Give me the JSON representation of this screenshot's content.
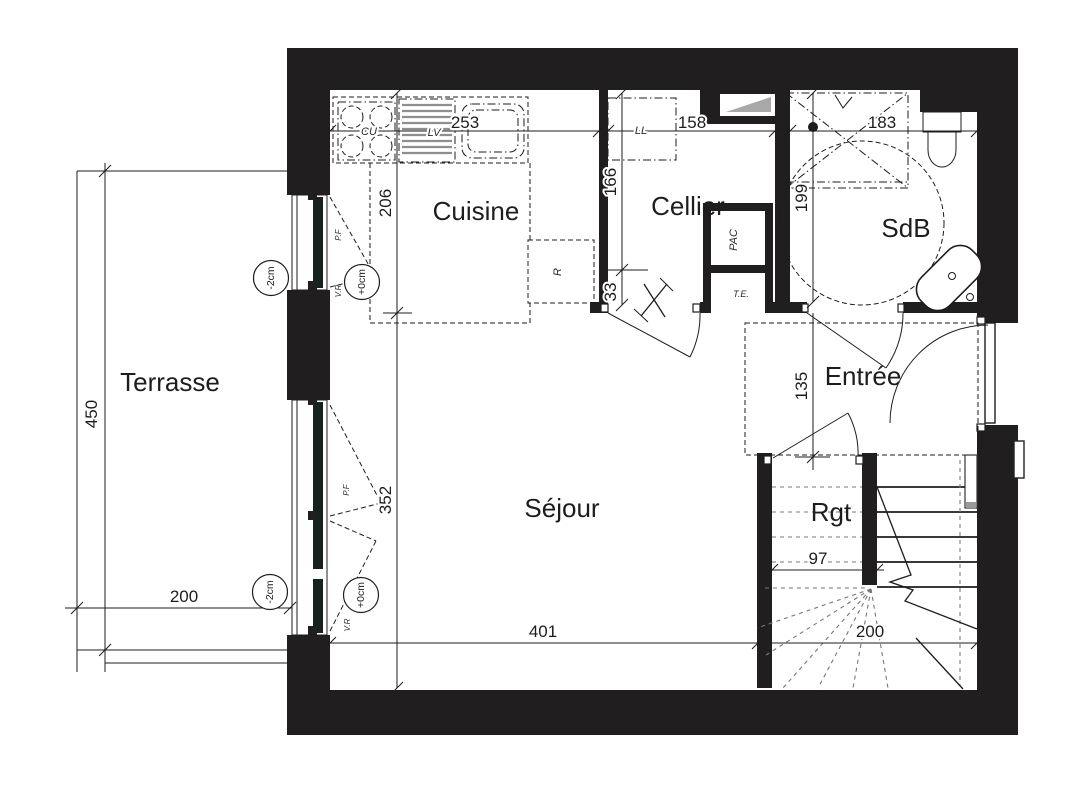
{
  "rooms": {
    "terrace": "Terrasse",
    "kitchen": "Cuisine",
    "cellar": "Cellier",
    "bath": "SdB",
    "hall": "Entrée",
    "living": "Séjour",
    "storage": "Rgt"
  },
  "dims": {
    "terrace_height": "450",
    "terrace_width": "200",
    "kitchen_width": "253",
    "kitchen_depth": "206",
    "cellar_width": "158",
    "cellar_depth": "166",
    "cellar_offset": "33",
    "bath_width": "183",
    "bath_depth": "199",
    "hall_depth": "135",
    "living_window": "352",
    "living_width": "401",
    "storage_width": "97",
    "stair_width": "200"
  },
  "fixtures": {
    "hob": "CU",
    "dishwasher": "LV",
    "washer": "LL",
    "heat_pump": "PAC",
    "electrical_panel": "T.E.",
    "fridge": "R"
  },
  "openings": {
    "french_door": "P.F",
    "roller_shutter": "V.R"
  },
  "levels": {
    "floor": "+0cm",
    "terrace": "-2cm"
  },
  "colors": {
    "wall": "#211e1f",
    "line": "#1d1d1b",
    "hatch": "#8e8e8e",
    "glazing": "#16221e"
  }
}
